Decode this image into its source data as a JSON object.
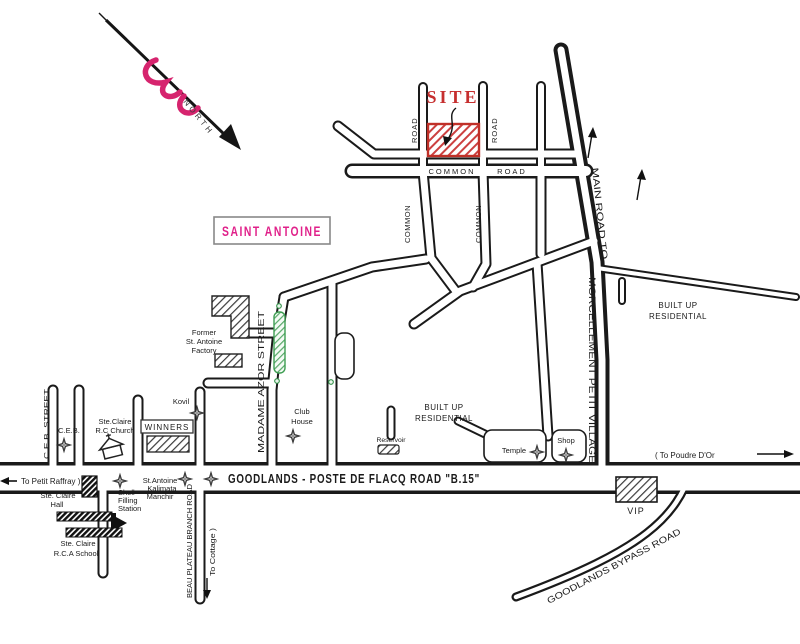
{
  "map": {
    "compass_label": "NORTH",
    "site_label": "SITE",
    "area_label": "SAINT ANTOINE",
    "colors": {
      "site_red": "#c62f2f",
      "area_pink": "#e0218a",
      "ornament_pink": "#d6246e",
      "feature_green": "#3f9e53",
      "ink_black": "#1a1a1a"
    },
    "roads": {
      "stub_road": "ROAD",
      "common_word": "COMMON",
      "road_word": "ROAD",
      "common_vert": "COMMON",
      "main_road_to": "MAIN ROAD TO",
      "morcellement": "MORCELLEMENT PETIT VILLAGE",
      "b15": "GOODLANDS - POSTE DE FLACQ ROAD \"B.15\"",
      "to_petit_raffray": "To Petit Raffray )",
      "to_poudre_dor": "( To Poudre D'Or",
      "bypass": "GOODLANDS BYPASS ROAD",
      "beau_plateau": "BEAU PLATEAU BRANCH ROAD",
      "to_cottage": "To Cottage )",
      "ceb_street": "C.E.B. STREET",
      "madame_azor_street": "MADAME AZOR STREET"
    },
    "places": {
      "built_up_1": "BUILT UP",
      "built_up_2": "RESIDENTIAL",
      "ceb": "C.E.B.",
      "church_1": "Ste.Claire",
      "church_2": "R.C Church",
      "winners": "WINNERS",
      "kovil": "Kovil",
      "hall_1": "Ste. Claire",
      "hall_2": "Hall",
      "school_1": "Ste. Claire",
      "school_2": "R.C.A School",
      "shell_1": "Shell",
      "shell_2": "Filling",
      "shell_3": "Station",
      "manchir_1": "St.Antoine",
      "manchir_2": "Kalimata",
      "manchir_3": "Manchir",
      "factory_1": "Former",
      "factory_2": "St. Antoine",
      "factory_3": "Factory",
      "club_1": "Club",
      "club_2": "House",
      "reservoir": "Reservoir",
      "temple": "Temple",
      "shop": "Shop",
      "vip": "VIP"
    }
  }
}
